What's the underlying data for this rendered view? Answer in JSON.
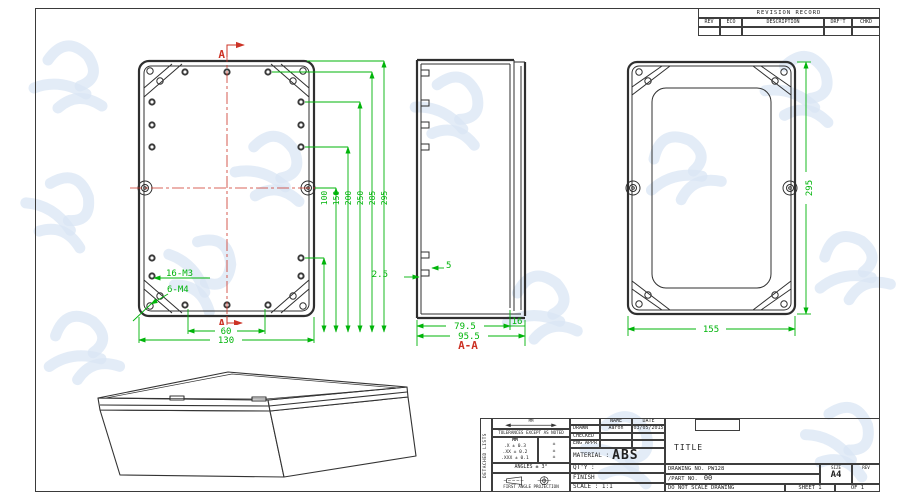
{
  "revision_table": {
    "title": "REVISION RECORD",
    "columns": [
      "REV",
      "ECO",
      "DESCRIPTION",
      "DRF'T",
      "CHKD"
    ]
  },
  "back_view": {
    "section_label_top": "A",
    "section_label_bottom": "A",
    "height_dims": [
      "100",
      "150",
      "200",
      "250",
      "285",
      "295"
    ],
    "dim_inner_width": "60",
    "dim_outer_width": "130",
    "label_small_holes": "16-M3",
    "label_corner_holes": "6-M4"
  },
  "section_view": {
    "dim_tab_offset": "2.5",
    "dim_tab": "5",
    "dim_inner_depth": "79.5",
    "dim_lid": "16",
    "dim_outer_depth": "95.5",
    "label": "A-A"
  },
  "front_view": {
    "dim_width": "155",
    "dim_height": "295"
  },
  "title_block": {
    "side_note": "DETACHED LISTS",
    "units_label": "MM",
    "tolerance_note": "TOLERANCES EXCEPT AS NOTED",
    "tolerance_unit_header": "MM",
    "tolerance_rows": [
      ".X ± 0.3",
      ".XX ± 0.2",
      ".XXX ± 0.1"
    ],
    "tolerance_marks": [
      "±",
      "±",
      "±"
    ],
    "angles": "ANGLES ± 3°",
    "projection": "FIRST ANGLE PROJECTION",
    "name_header": "NAME",
    "date_header": "DATE",
    "drawn_label": "DRAWN",
    "drawn_name": "Aaron",
    "drawn_date": "03/05/2015",
    "checked_label": "CHECKED",
    "eng_appr_label": "ENG APPR",
    "material_label": "MATERIAL :",
    "material_value": "ABS",
    "qty_label": "QT'Y :",
    "finish_label": "FINISH",
    "scale_label": "SCALE : 1:1",
    "title_label": "TITLE",
    "drawing_no": "DRAWING NO. PW128",
    "part_no_label": "/PART  NO.",
    "part_no_value": "00",
    "size_label": "SIZE",
    "size_value": "A4",
    "rev_label": "REV",
    "note": "DO NOT SCALE DRAWING",
    "sheet_label": "SHEET 1",
    "of_label": "OF 1"
  },
  "colors": {
    "dimension_green": "#00b40a",
    "centerline_red": "#cc3326",
    "line_dark": "#2f2f2f",
    "watermark_blue": "#d9e6f4"
  }
}
